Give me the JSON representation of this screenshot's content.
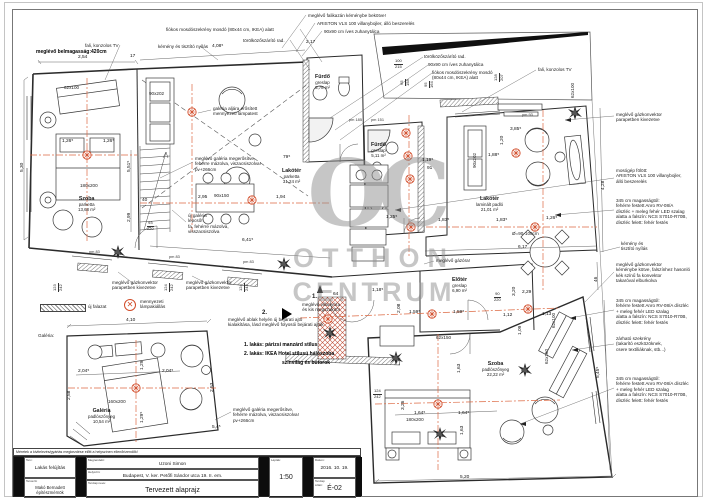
{
  "colors": {
    "axis": "#dd6a44",
    "lamp": "#d14b28",
    "line": "#2b2b2b",
    "watermark": "#8f8f8f",
    "wedge": "#101010"
  },
  "watermark": {
    "monogram": "OC",
    "line1": "OTTHON",
    "line2": "CENTRUM"
  },
  "legend": {
    "wall_label": "új falazat",
    "lamp_label": "mennyezeti\nlámpakiállás",
    "lamp_glyph": "✕"
  },
  "markers": [
    {
      "label": "1.",
      "x": 312,
      "y": 294
    },
    {
      "label": "2.",
      "x": 262,
      "y": 310
    }
  ],
  "title_block": {
    "note": "Méretek a kivitelezés/gyártás megkezdése előtt a helyszínen ellenőrizendők!",
    "terv_label": "Terv:",
    "terv": "Lakás felújítás",
    "tervezo_label": "Tervező:",
    "tervezo": "Makó Bernadett\népítészmérnök",
    "megrendelo_label": "Megrendelő:",
    "megrendelo": "Uzoni Simon",
    "helyszin_label": "Helyszín:",
    "helyszin": "Budapest, V. ker. Petőfi Sándor utca 19. II. em.",
    "tervlap_label": "Tervlap neve:",
    "tervlap": "Tervezett alaprajz",
    "leptek_label": "Lépték:",
    "leptek": "1:50",
    "datum_label": "Dátum:",
    "datum": "2016. 10. 19.",
    "szam_label": "Tervlap\nszám:",
    "szam": "É-02"
  },
  "rooms": [
    {
      "t": "Szoba\nparketta\n13,68 m²",
      "x": 78,
      "y": 196
    },
    {
      "t": "Lakótér\nparketta\n31,24 m²",
      "x": 282,
      "y": 168
    },
    {
      "t": "Fürdő\ngreslap\n5,78 m²",
      "x": 315,
      "y": 74
    },
    {
      "t": "Fürdő\ngreslap\n5,11 m²",
      "x": 371,
      "y": 142
    },
    {
      "t": "Lakótér\nlaminált padló\n21,01 m²",
      "x": 476,
      "y": 196
    },
    {
      "t": "Előtér\ngreslap\n6,90 m²",
      "x": 452,
      "y": 277
    },
    {
      "t": "Szoba\npadlószőnyeg\n22,22 m²",
      "x": 482,
      "y": 361
    },
    {
      "t": "Galéria\npadlószőnyeg\n10,54 m²",
      "x": 88,
      "y": 408
    }
  ],
  "annotations": [
    {
      "t": "meglévő falikazán kéménybe bekötve!",
      "x": 308,
      "y": 13
    },
    {
      "t": "ARISTON VLS 100 villanybojler, álló beszerelés",
      "x": 317,
      "y": 21
    },
    {
      "t": "90x90 cm íves zuhanytálca",
      "x": 324,
      "y": 29
    },
    {
      "t": "fiókos mosdószekrény mosdó (80x44 cm, IKEA) alatt",
      "x": 166,
      "y": 27
    },
    {
      "t": "törölközőszárító rad.",
      "x": 243,
      "y": 38
    },
    {
      "t": "fali, konzolos TV",
      "x": 85,
      "y": 43
    },
    {
      "t": "kémény  és tisztító nyílás",
      "x": 158,
      "y": 44
    },
    {
      "t": "meglévő belmagasság:420cm",
      "x": 36,
      "y": 50,
      "b": 1
    },
    {
      "t": "törölközőszárító rad.",
      "x": 424,
      "y": 54
    },
    {
      "t": "90x90 cm íves zuhanytálca",
      "x": 428,
      "y": 62
    },
    {
      "t": "fiókos mosdószekrény mosdó\n(80x44 cm, IKEA) alatt",
      "x": 432,
      "y": 70
    },
    {
      "t": "fali, konzolos TV",
      "x": 538,
      "y": 67
    },
    {
      "t": "meglévő gázkonvektor\nparapetben kivezetve",
      "x": 616,
      "y": 112
    },
    {
      "t": "mosógép fölött:\nARISTON VLS 100 villanybojler,\nálló beszerelés",
      "x": 616,
      "y": 168
    },
    {
      "t": "345 cm magasságtól:\nfehérre festett Anro RV-08/A\ndíszléc + meleg fehér LED szalag\nalatta a falszín: NCS S7010-R70B,\ndíszléc felett: fehér festés",
      "x": 616,
      "y": 198
    },
    {
      "t": "kémény és\ntisztító nyílás",
      "x": 621,
      "y": 241
    },
    {
      "t": "meglévő gázkonvektor\nkéménybe kötve, falszínhez hasonló\nkék színű fa konvektor\ntakaróval elburkolva",
      "x": 616,
      "y": 262
    },
    {
      "t": "345 cm magasságtól:\nfehérre festett Anro RV-08/A díszléc\n+ meleg fehér LED szalag\nalatta a falszín: NCS S7010-R70B,\ndíszléc felett: fehér festés",
      "x": 616,
      "y": 298
    },
    {
      "t": "zárható szekrény\n(takarító eszközöknek,\ncsere textíliáknak, stb...)",
      "x": 616,
      "y": 336
    },
    {
      "t": "345 cm magasságtól:\nfehérre festett Anro RV-08/A díszléc\n+ meleg fehér LED szalag\nalatta a falszín: NCS S7010-R70B,\ndíszléc felett: fehér festés",
      "x": 616,
      "y": 376
    },
    {
      "t": "galéria aljára erősített\nmennyezeti lámpatest",
      "x": 213,
      "y": 106
    },
    {
      "t": "meglévő galéria megerősítve,\nfehérre mázolva, viszacsiszolva!\npv+266cm",
      "x": 195,
      "y": 156
    },
    {
      "t": "új galéria\nlépcső!\nfa, fehérre mázolva,\nvisszacsiszolva",
      "x": 188,
      "y": 213
    },
    {
      "t": "meglévő gázóra!",
      "x": 436,
      "y": 258
    },
    {
      "t": "meglévő gázkonvektor\nparapetben kivezetve",
      "x": 112,
      "y": 280
    },
    {
      "t": "meglévő gázkonvektor\nparapetben kivezetve",
      "x": 186,
      "y": 280
    },
    {
      "t": "meglévő villanyóra\nés kis megszakító!",
      "x": 264,
      "y": 302,
      "al": "r",
      "w": 76
    },
    {
      "t": "meglévő ablak helyén új bejárati ajtó\nkialakítása, lásd meglévő folyosói bejárati ajtók",
      "x": 228,
      "y": 317
    },
    {
      "t": "1. lakás: párizsi manzárd stílus",
      "x": 244,
      "y": 343,
      "b": 1
    },
    {
      "t": "2. lakás: IKEA Hotel stílusú hálószoba",
      "x": 244,
      "y": 352,
      "b": 1
    },
    {
      "t": "szinvilág és bútorok",
      "x": 282,
      "y": 361,
      "b": 1
    },
    {
      "t": "meglévő galéria megerősítve,\nfehérre mázolva, viszacsiszolva!\npv+266cm",
      "x": 233,
      "y": 407
    },
    {
      "t": "Galéria:",
      "x": 38,
      "y": 333
    }
  ],
  "dimensions": [
    {
      "t": "2,54",
      "x": 78,
      "y": 55
    },
    {
      "t": "17",
      "x": 130,
      "y": 54
    },
    {
      "t": "4,08⁵",
      "x": 212,
      "y": 44
    },
    {
      "t": "2,17",
      "x": 306,
      "y": 40
    },
    {
      "t": "5,30",
      "x": 20,
      "y": 172,
      "r": 1
    },
    {
      "t": "1,26⁵",
      "x": 62,
      "y": 139
    },
    {
      "t": "1,26⁵",
      "x": 103,
      "y": 139
    },
    {
      "t": "5,51⁵",
      "x": 127,
      "y": 172,
      "r": 1
    },
    {
      "t": "2,99",
      "x": 127,
      "y": 222,
      "r": 1
    },
    {
      "t": "40",
      "x": 142,
      "y": 198
    },
    {
      "t": "2,95",
      "x": 198,
      "y": 195
    },
    {
      "t": "1,94",
      "x": 276,
      "y": 195
    },
    {
      "t": "6,41⁵",
      "x": 242,
      "y": 238
    },
    {
      "t": "79⁵",
      "x": 283,
      "y": 155
    },
    {
      "t": "3,85⁵",
      "x": 510,
      "y": 127
    },
    {
      "t": "1,20",
      "x": 500,
      "y": 145,
      "r": 1
    },
    {
      "t": "1,88⁵",
      "x": 488,
      "y": 153
    },
    {
      "t": "1,19⁵",
      "x": 422,
      "y": 158
    },
    {
      "t": "91",
      "x": 427,
      "y": 166
    },
    {
      "t": "1,25⁵",
      "x": 386,
      "y": 215
    },
    {
      "t": "1,83⁵",
      "x": 438,
      "y": 218
    },
    {
      "t": "1,83⁵",
      "x": 496,
      "y": 218
    },
    {
      "t": "1,26⁵",
      "x": 546,
      "y": 216
    },
    {
      "t": "6,17",
      "x": 518,
      "y": 245
    },
    {
      "t": "4,28",
      "x": 601,
      "y": 190,
      "r": 1
    },
    {
      "t": "46",
      "x": 594,
      "y": 282,
      "r": 1
    },
    {
      "t": "5,45⁵",
      "x": 596,
      "y": 378,
      "r": 1
    },
    {
      "t": "1,18⁵",
      "x": 372,
      "y": 288
    },
    {
      "t": "64",
      "x": 333,
      "y": 292
    },
    {
      "t": "2,08",
      "x": 397,
      "y": 313,
      "r": 1
    },
    {
      "t": "1,59⁵",
      "x": 409,
      "y": 310
    },
    {
      "t": "1,59⁵",
      "x": 453,
      "y": 310
    },
    {
      "t": "1,12",
      "x": 503,
      "y": 313
    },
    {
      "t": "1,13",
      "x": 542,
      "y": 312
    },
    {
      "t": "2,29",
      "x": 522,
      "y": 290
    },
    {
      "t": "1,09",
      "x": 518,
      "y": 335,
      "r": 1
    },
    {
      "t": "3,20",
      "x": 512,
      "y": 296,
      "r": 1
    },
    {
      "t": "1,63",
      "x": 457,
      "y": 373,
      "r": 1
    },
    {
      "t": "3,26",
      "x": 401,
      "y": 410,
      "r": 1
    },
    {
      "t": "1,63",
      "x": 460,
      "y": 435,
      "r": 1
    },
    {
      "t": "1,64⁵",
      "x": 414,
      "y": 411
    },
    {
      "t": "1,64⁵",
      "x": 458,
      "y": 411
    },
    {
      "t": "5,20",
      "x": 460,
      "y": 475
    },
    {
      "t": "4,10",
      "x": 126,
      "y": 318
    },
    {
      "t": "2,04⁵",
      "x": 78,
      "y": 369
    },
    {
      "t": "2,04⁵",
      "x": 162,
      "y": 369
    },
    {
      "t": "2,53",
      "x": 210,
      "y": 392,
      "r": 1
    },
    {
      "t": "2,58",
      "x": 67,
      "y": 400,
      "r": 1
    },
    {
      "t": "1,29",
      "x": 140,
      "y": 370,
      "r": 1
    },
    {
      "t": "1,29⁵",
      "x": 140,
      "y": 423,
      "r": 1
    },
    {
      "t": "5,4⁵",
      "x": 212,
      "y": 425
    }
  ],
  "furniture_labels": [
    {
      "t": "62x100",
      "x": 64,
      "y": 85
    },
    {
      "t": "90x202",
      "x": 149,
      "y": 91
    },
    {
      "t": "180x200",
      "x": 80,
      "y": 183
    },
    {
      "t": "90x150",
      "x": 214,
      "y": 193
    },
    {
      "t": "90x202",
      "x": 472,
      "y": 168,
      "r": 1
    },
    {
      "t": "Ø=90-100cm",
      "x": 512,
      "y": 231
    },
    {
      "t": "62x100",
      "x": 570,
      "y": 98,
      "r": 1
    },
    {
      "t": "62x150",
      "x": 436,
      "y": 335
    },
    {
      "t": "160x200",
      "x": 108,
      "y": 399
    },
    {
      "t": "180x200",
      "x": 406,
      "y": 417
    },
    {
      "t": "62x100",
      "x": 551,
      "y": 328,
      "r": 1
    },
    {
      "t": "62x160",
      "x": 544,
      "y": 364,
      "r": 1
    }
  ],
  "fractions": [
    {
      "t": "93\n220",
      "x": 147,
      "y": 221
    },
    {
      "t": "100\n215",
      "x": 394,
      "y": 59
    },
    {
      "t": "90\n220",
      "x": 494,
      "y": 292
    },
    {
      "t": "124\n242",
      "x": 373,
      "y": 389
    },
    {
      "t": "123\n242",
      "x": 53,
      "y": 292,
      "r": 1
    },
    {
      "t": "124\n242",
      "x": 164,
      "y": 292,
      "r": 1
    },
    {
      "t": "124\n242",
      "x": 239,
      "y": 292,
      "r": 1
    },
    {
      "t": "65\n158",
      "x": 400,
      "y": 86,
      "r": 1
    },
    {
      "t": "95\n164",
      "x": 424,
      "y": 88,
      "r": 1
    },
    {
      "t": "128\n207",
      "x": 494,
      "y": 82,
      "r": 1
    }
  ],
  "pm_labels": [
    {
      "t": "pm 83",
      "x": 89,
      "y": 250
    },
    {
      "t": "pm 83",
      "x": 169,
      "y": 255
    },
    {
      "t": "pm 83",
      "x": 243,
      "y": 260
    },
    {
      "t": "pm 93",
      "x": 522,
      "y": 113
    },
    {
      "t": "pm 185",
      "x": 349,
      "y": 118
    },
    {
      "t": "pm 151",
      "x": 371,
      "y": 118
    }
  ]
}
